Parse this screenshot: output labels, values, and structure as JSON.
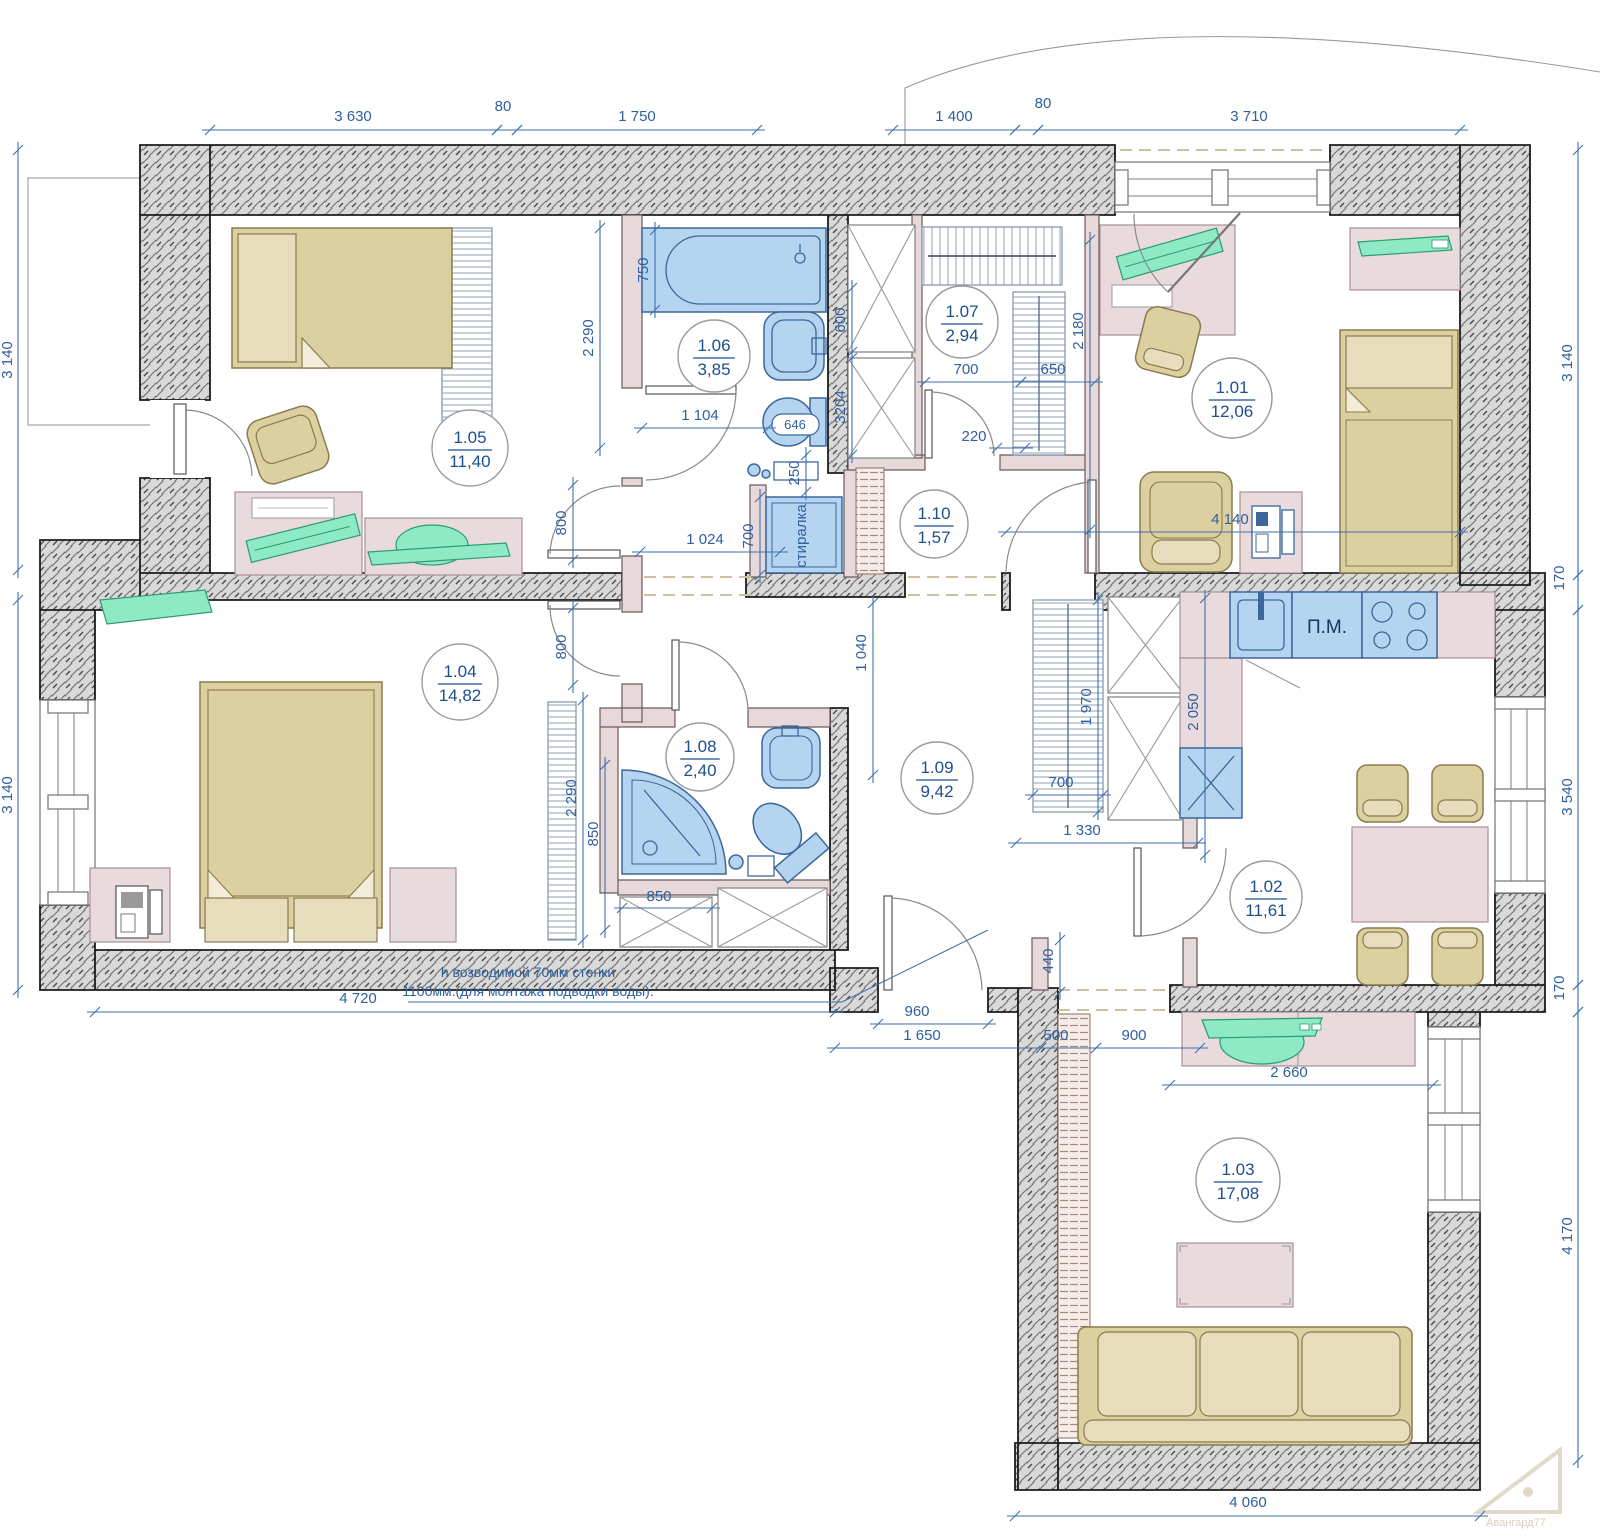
{
  "colors": {
    "dimension_blue": "#2f5f9e",
    "wall_hatch_gray": "#d9d9d9",
    "fixture_blue": "#b5d4f0",
    "furniture_tan": "#ddd0a0",
    "accent_green": "#8deac5",
    "partition_pink": "#e7d8da"
  },
  "rooms": [
    {
      "number": "1.01",
      "area": "12,06",
      "cx": 1232,
      "cy": 398,
      "r": 40
    },
    {
      "number": "1.02",
      "area": "11,61",
      "cx": 1266,
      "cy": 897,
      "r": 36
    },
    {
      "number": "1.03",
      "area": "17,08",
      "cx": 1238,
      "cy": 1180,
      "r": 42
    },
    {
      "number": "1.04",
      "area": "14,82",
      "cx": 460,
      "cy": 682,
      "r": 38
    },
    {
      "number": "1.05",
      "area": "11,40",
      "cx": 470,
      "cy": 448,
      "r": 38
    },
    {
      "number": "1.06",
      "area": "3,85",
      "cx": 714,
      "cy": 356,
      "r": 36
    },
    {
      "number": "1.07",
      "area": "2,94",
      "cx": 962,
      "cy": 322,
      "r": 36
    },
    {
      "number": "1.08",
      "area": "2,40",
      "cx": 700,
      "cy": 757,
      "r": 34
    },
    {
      "number": "1.09",
      "area": "9,42",
      "cx": 937,
      "cy": 778,
      "r": 36
    },
    {
      "number": "1.10",
      "area": "1,57",
      "cx": 934,
      "cy": 524,
      "r": 34
    }
  ],
  "dimensions": [
    {
      "text": "3 630",
      "x1": 210,
      "y1": 130,
      "x2": 497,
      "y2": 130,
      "tx": 353,
      "ty": 121,
      "rot": 0
    },
    {
      "text": "80",
      "x1": 497,
      "y1": 130,
      "x2": 517,
      "y2": 130,
      "tx": 503,
      "ty": 111,
      "rot": 0
    },
    {
      "text": "1 750",
      "x1": 517,
      "y1": 130,
      "x2": 757,
      "y2": 130,
      "tx": 637,
      "ty": 121,
      "rot": 0
    },
    {
      "text": "1 400",
      "x1": 893,
      "y1": 130,
      "x2": 1015,
      "y2": 130,
      "tx": 954,
      "ty": 121,
      "rot": 0
    },
    {
      "text": "80",
      "x1": 1015,
      "y1": 130,
      "x2": 1038,
      "y2": 130,
      "tx": 1043,
      "ty": 108,
      "rot": 0
    },
    {
      "text": "3 710",
      "x1": 1038,
      "y1": 130,
      "x2": 1460,
      "y2": 130,
      "tx": 1249,
      "ty": 121,
      "rot": 0
    },
    {
      "text": "3 140",
      "x1": 18,
      "y1": 150,
      "x2": 18,
      "y2": 570,
      "tx": 12,
      "ty": 360,
      "rot": 1
    },
    {
      "text": "3 140",
      "x1": 18,
      "y1": 600,
      "x2": 18,
      "y2": 990,
      "tx": 12,
      "ty": 795,
      "rot": 1
    },
    {
      "text": "3 140",
      "x1": 1578,
      "y1": 150,
      "x2": 1578,
      "y2": 575,
      "tx": 1572,
      "ty": 363,
      "rot": 1
    },
    {
      "text": "170",
      "x1": 1578,
      "y1": 575,
      "x2": 1578,
      "y2": 610,
      "tx": 1564,
      "ty": 578,
      "rot": 1
    },
    {
      "text": "3 540",
      "x1": 1578,
      "y1": 610,
      "x2": 1578,
      "y2": 985,
      "tx": 1572,
      "ty": 797,
      "rot": 1
    },
    {
      "text": "170",
      "x1": 1578,
      "y1": 985,
      "x2": 1578,
      "y2": 1012,
      "tx": 1564,
      "ty": 988,
      "rot": 1
    },
    {
      "text": "4 170",
      "x1": 1578,
      "y1": 1012,
      "x2": 1578,
      "y2": 1460,
      "tx": 1572,
      "ty": 1236,
      "rot": 1
    },
    {
      "text": "4 060",
      "x1": 1015,
      "y1": 1516,
      "x2": 1480,
      "y2": 1516,
      "tx": 1248,
      "ty": 1507,
      "rot": 0
    },
    {
      "text": "4 720",
      "x1": 95,
      "y1": 1012,
      "x2": 835,
      "y2": 1012,
      "tx": 358,
      "ty": 1003,
      "rot": 0
    },
    {
      "text": "2 290",
      "x1": 600,
      "y1": 228,
      "x2": 600,
      "y2": 448,
      "tx": 593,
      "ty": 338,
      "rot": 1
    },
    {
      "text": "750",
      "x1": 655,
      "y1": 230,
      "x2": 655,
      "y2": 310,
      "tx": 648,
      "ty": 270,
      "rot": 1
    },
    {
      "text": "1 104",
      "x1": 642,
      "y1": 428,
      "x2": 768,
      "y2": 428,
      "tx": 700,
      "ty": 420,
      "rot": 0
    },
    {
      "text": "250",
      "x1": 806,
      "y1": 455,
      "x2": 806,
      "y2": 492,
      "tx": 799,
      "ty": 473,
      "rot": 1
    },
    {
      "text": "700",
      "x1": 760,
      "y1": 497,
      "x2": 760,
      "y2": 575,
      "tx": 753,
      "ty": 536,
      "rot": 1
    },
    {
      "text": "1 024",
      "x1": 640,
      "y1": 552,
      "x2": 780,
      "y2": 552,
      "tx": 705,
      "ty": 544,
      "rot": 0
    },
    {
      "text": "800",
      "x1": 573,
      "y1": 485,
      "x2": 573,
      "y2": 560,
      "tx": 566,
      "ty": 523,
      "rot": 1
    },
    {
      "text": "800",
      "x1": 573,
      "y1": 608,
      "x2": 573,
      "y2": 685,
      "tx": 566,
      "ty": 647,
      "rot": 1
    },
    {
      "text": "600",
      "x1": 852,
      "y1": 288,
      "x2": 852,
      "y2": 352,
      "tx": 845,
      "ty": 320,
      "rot": 1
    },
    {
      "text": "3204",
      "x1": 852,
      "y1": 358,
      "x2": 852,
      "y2": 455,
      "tx": 845,
      "ty": 407,
      "rot": 1
    },
    {
      "text": "700",
      "x1": 925,
      "y1": 382,
      "x2": 1021,
      "y2": 382,
      "tx": 966,
      "ty": 374,
      "rot": 0
    },
    {
      "text": "650",
      "x1": 1021,
      "y1": 382,
      "x2": 1095,
      "y2": 382,
      "tx": 1053,
      "ty": 374,
      "rot": 0
    },
    {
      "text": "220",
      "x1": 997,
      "y1": 448,
      "x2": 1025,
      "y2": 448,
      "tx": 974,
      "ty": 441,
      "rot": 0
    },
    {
      "text": "2 180",
      "x1": 1090,
      "y1": 240,
      "x2": 1090,
      "y2": 530,
      "tx": 1083,
      "ty": 331,
      "rot": 1
    },
    {
      "text": "4 140",
      "x1": 1006,
      "y1": 532,
      "x2": 1460,
      "y2": 532,
      "tx": 1230,
      "ty": 524,
      "rot": 0
    },
    {
      "text": "1 040",
      "x1": 873,
      "y1": 603,
      "x2": 873,
      "y2": 775,
      "tx": 866,
      "ty": 653,
      "rot": 1
    },
    {
      "text": "1 970",
      "x1": 1098,
      "y1": 600,
      "x2": 1098,
      "y2": 812,
      "tx": 1091,
      "ty": 707,
      "rot": 1
    },
    {
      "text": "700",
      "x1": 1033,
      "y1": 795,
      "x2": 1103,
      "y2": 795,
      "tx": 1061,
      "ty": 787,
      "rot": 0
    },
    {
      "text": "1 330",
      "x1": 1016,
      "y1": 843,
      "x2": 1198,
      "y2": 843,
      "tx": 1082,
      "ty": 835,
      "rot": 0
    },
    {
      "text": "2 050",
      "x1": 1205,
      "y1": 598,
      "x2": 1205,
      "y2": 855,
      "tx": 1198,
      "ty": 712,
      "rot": 1
    },
    {
      "text": "2 290",
      "x1": 583,
      "y1": 700,
      "x2": 583,
      "y2": 940,
      "tx": 576,
      "ty": 798,
      "rot": 1
    },
    {
      "text": "850",
      "x1": 605,
      "y1": 765,
      "x2": 605,
      "y2": 930,
      "tx": 598,
      "ty": 834,
      "rot": 1
    },
    {
      "text": "850",
      "x1": 622,
      "y1": 908,
      "x2": 712,
      "y2": 908,
      "tx": 659,
      "ty": 901,
      "rot": 0
    },
    {
      "text": "960",
      "x1": 878,
      "y1": 1024,
      "x2": 988,
      "y2": 1024,
      "tx": 917,
      "ty": 1016,
      "rot": 0
    },
    {
      "text": "1 650",
      "x1": 835,
      "y1": 1048,
      "x2": 1041,
      "y2": 1048,
      "tx": 922,
      "ty": 1040,
      "rot": 0
    },
    {
      "text": "500",
      "x1": 1041,
      "y1": 1048,
      "x2": 1096,
      "y2": 1048,
      "tx": 1056,
      "ty": 1040,
      "rot": 0
    },
    {
      "text": "900",
      "x1": 1096,
      "y1": 1048,
      "x2": 1200,
      "y2": 1048,
      "tx": 1134,
      "ty": 1040,
      "rot": 0
    },
    {
      "text": "440",
      "x1": 1060,
      "y1": 940,
      "x2": 1060,
      "y2": 992,
      "tx": 1053,
      "ty": 961,
      "rot": 1
    },
    {
      "text": "2 660",
      "x1": 1170,
      "y1": 1085,
      "x2": 1433,
      "y2": 1085,
      "tx": 1289,
      "ty": 1077,
      "rot": 0
    }
  ],
  "labels": [
    {
      "text": "стиралка",
      "x": 806,
      "y": 536,
      "rot": 1,
      "size": 15,
      "color": "#2f5f9e"
    },
    {
      "text": "П.М.",
      "x": 1327,
      "y": 633,
      "rot": 0,
      "size": 19,
      "color": "#16365c"
    },
    {
      "text": "h возводимой 70мм стенки",
      "x": 528,
      "y": 977,
      "rot": 0,
      "size": 14,
      "color": "#2f5f9e"
    },
    {
      "text": "1100мм.(для монтажа подводки воды).",
      "x": 528,
      "y": 996,
      "rot": 0,
      "size": 14,
      "color": "#2f5f9e"
    },
    {
      "text": "646",
      "x": 795,
      "y": 429,
      "rot": 0,
      "size": 13,
      "color": "#2f5f9e"
    },
    {
      "text": "Авангард77",
      "x": 1516,
      "y": 1526,
      "rot": 0,
      "size": 11,
      "color": "#d7cfc0"
    }
  ]
}
